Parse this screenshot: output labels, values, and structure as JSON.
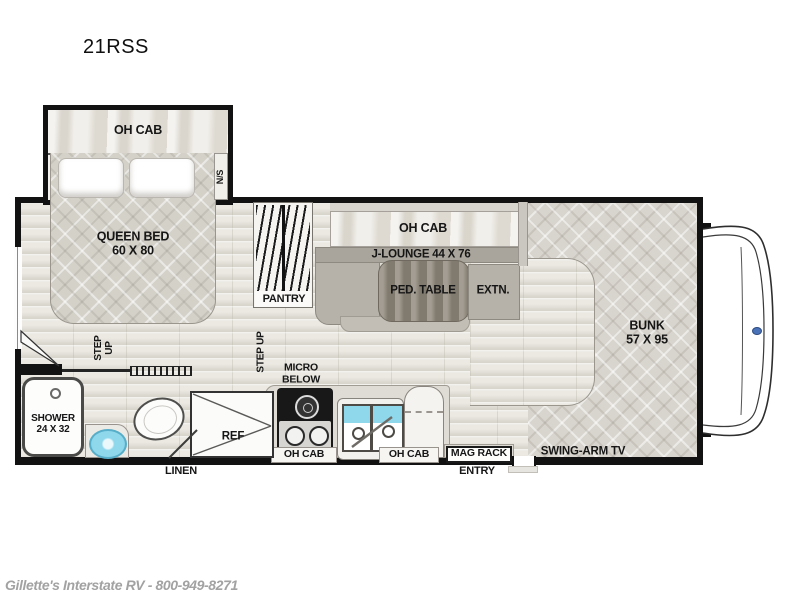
{
  "title": "21RSS",
  "watermark": "Gillette's Interstate RV - 800-949-8271",
  "bedroom": {
    "oh_cab": "OH CAB",
    "nightstand": "N/S",
    "queen_bed": "QUEEN BED\n60 X 80"
  },
  "hall": {
    "pantry": "PANTRY",
    "step_up_left": "STEP\nUP",
    "step_up_right": "STEP UP"
  },
  "dinette": {
    "oh_cab": "OH CAB",
    "lounge": "J-LOUNGE 44 X 76",
    "table": "PED. TABLE",
    "extension": "EXTN."
  },
  "bunk": {
    "label": "BUNK\n57 X 95",
    "tv": "SWING-ARM TV"
  },
  "kitchen": {
    "micro": "MICRO\nBELOW",
    "oh_cab_left": "OH CAB",
    "oh_cab_right": "OH CAB",
    "mag_rack": "MAG RACK",
    "entry": "ENTRY",
    "fridge": "REF"
  },
  "bath": {
    "shower": "SHOWER\n24 X 32",
    "linen": "LINEN"
  },
  "colors": {
    "wall": "#121212",
    "floor": "#ebe9e2",
    "mattress": "#d8d5ce",
    "cabinet_wood": "#e8e5de",
    "bench": "#b6b2a9",
    "table": "#8f887c",
    "water": "#8fd8ec",
    "emblem": "#4a72b8"
  }
}
